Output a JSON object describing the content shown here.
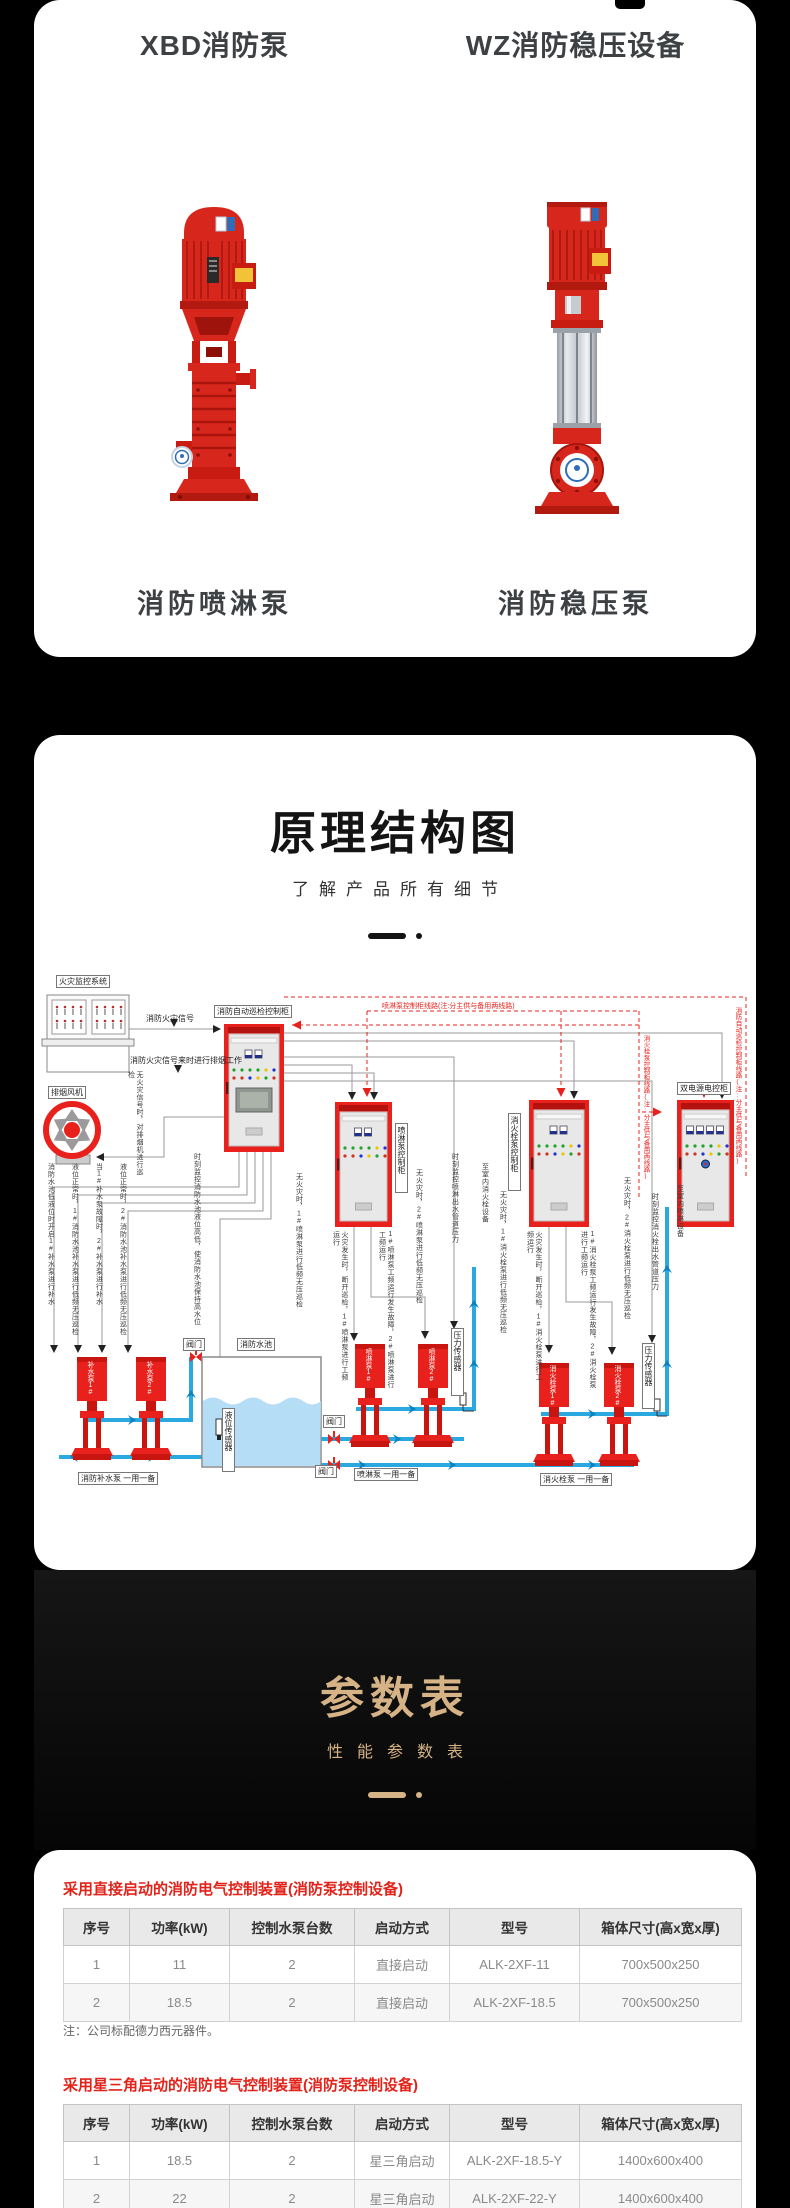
{
  "colors": {
    "accent_red": "#e8211d",
    "gold": "#d6b387",
    "table_title_red": "#e2231a",
    "pipe_blue": "#2aa9e0",
    "dark_text": "#3e4144"
  },
  "hero": {
    "left_title": "XBD消防泵",
    "right_title": "WZ消防稳压设备",
    "left_caption": "消防喷淋泵",
    "right_caption": "消防稳压泵"
  },
  "structure": {
    "title": "原理结构图",
    "subtitle": "了解产品所有细节"
  },
  "params": {
    "title": "参数表",
    "subtitle": "性能参数表"
  },
  "diagram": {
    "fire_monitor_system": "火灾监控系统",
    "fire_signal": "消防火灾信号",
    "smoke_work": "消防火灾信号来时进行排烟工作",
    "smoke_fan": "排烟风机",
    "fan_note": "无火灾信号时，对排烟机进行巡检",
    "auto_patrol_cabinet": "消防自动巡检控制柜",
    "spray_cabinet": "喷淋泵控制柜",
    "hydrant_cabinet": "消火栓泵控制柜",
    "dual_power_cabinet": "双电源电控柜",
    "spray_line_note": "喷淋泵控制柜线路(注:分主供与备用两线路)",
    "hydrant_line_note": "消火栓泵控制柜线路(注:分主供与备用两线路)",
    "patrol_line_note": "消防自动巡检控制柜线路(注:分主供与备用两线路)",
    "tank": "消防水池",
    "valve": "阀门",
    "level_sensor": "液位传感器",
    "pressure_sensor": "压力传感器",
    "pumps": {
      "bushui1": "补水泵1#",
      "bushui2": "补水泵2#",
      "penlin1": "喷淋泵1#",
      "penlin2": "喷淋泵2#",
      "hydrant1": "消火栓泵1#",
      "hydrant2": "消火栓泵2#"
    },
    "pair_labels": {
      "bushui": "消防补水泵 一用一备",
      "penlin": "喷淋泵 一用一备",
      "hydrant": "消火栓泵 一用一备"
    },
    "annotations": [
      "消防水池低液位时开启1#补水泵进行补水",
      "液位正常时，1#消防水池补水泵进行低频无压巡检",
      "当1#补水泵故障时，2#补水泵进行补水",
      "液位正常时，2#消防水池补水泵进行低频无压巡检",
      "时刻监控消防水池液位高低，使消防水池保持高水位",
      "无火灾时，1#喷淋泵进行低频无压巡检",
      "火灾发生时，断开巡检，1#喷淋泵进行工频运行",
      "1#喷淋泵工频运行发生故障，2#喷淋泵进行工频运行",
      "无火灾时，2#喷淋泵进行低频无压巡检",
      "时刻监控喷淋出水管道压力",
      "至室内消火栓设备",
      "无火灾时，1#消火栓泵进行低频无压巡检",
      "火灾发生时，断开巡检，1#消火栓泵进行工频运行",
      "1#消火栓泵工频运行发生故障，2#消火栓泵进行工频运行",
      "无火灾时，2#消火栓泵进行低频无压巡检",
      "时刻监控消火栓出水管道压力",
      "至室内喷淋设备"
    ]
  },
  "tables": [
    {
      "title": "采用直接启动的消防电气控制装置(消防泵控制设备)",
      "headers": [
        "序号",
        "功率(kW)",
        "控制水泵台数",
        "启动方式",
        "型号",
        "箱体尺寸(高x宽x厚)"
      ],
      "rows": [
        [
          "1",
          "11",
          "2",
          "直接启动",
          "ALK-2XF-11",
          "700x500x250"
        ],
        [
          "2",
          "18.5",
          "2",
          "直接启动",
          "ALK-2XF-18.5",
          "700x500x250"
        ]
      ],
      "note": "注：公司标配德力西元器件。"
    },
    {
      "title": "采用星三角启动的消防电气控制装置(消防泵控制设备)",
      "headers": [
        "序号",
        "功率(kW)",
        "控制水泵台数",
        "启动方式",
        "型号",
        "箱体尺寸(高x宽x厚)"
      ],
      "rows": [
        [
          "1",
          "18.5",
          "2",
          "星三角启动",
          "ALK-2XF-18.5-Y",
          "1400x600x400"
        ],
        [
          "2",
          "22",
          "2",
          "星三角启动",
          "ALK-2XF-22-Y",
          "1400x600x400"
        ]
      ],
      "note": ""
    }
  ]
}
